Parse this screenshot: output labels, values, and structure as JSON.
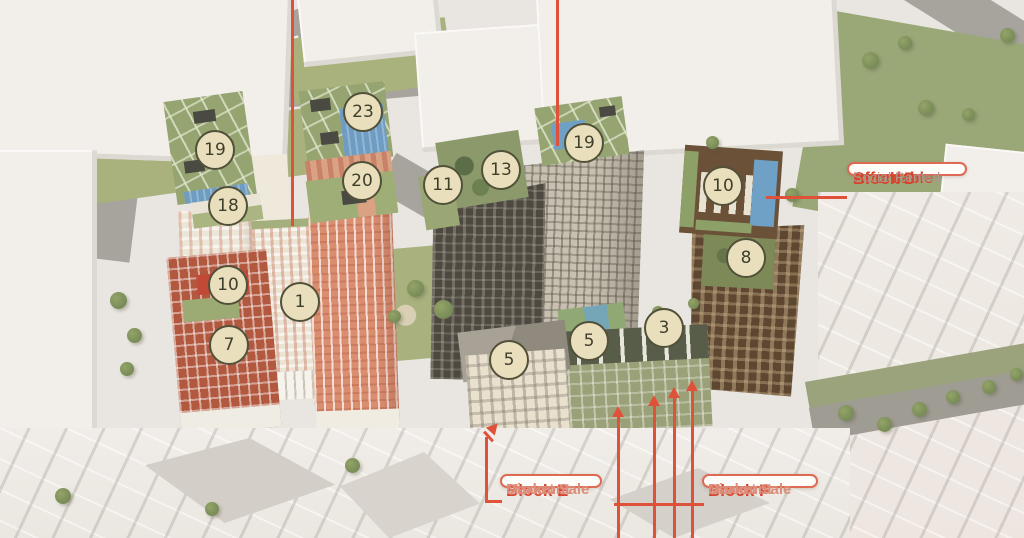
{
  "badges": [
    "19",
    "18",
    "10",
    "7",
    "23",
    "20",
    "1",
    "11",
    "13",
    "19",
    "10",
    "8",
    "5",
    "5",
    "3"
  ],
  "callouts": {
    "block_d": {
      "line1": "Block D",
      "line2": "Affordable",
      "line3": "Social Rented"
    },
    "block_e": {
      "line1": "Block E",
      "line2": "Discount",
      "line3": "Market Sale"
    },
    "block_f": {
      "line1": "Block F",
      "line2": "Discount",
      "line3": "Market Sale"
    }
  },
  "colors": {
    "annotation_red": "#e0513a",
    "callout_border": "#dd6a52",
    "callout_title": "#d6452e",
    "callout_subtitle": "#dd8d7a",
    "callout_muted": "#b5938a",
    "badge_fill": "#eadfbc",
    "badge_border": "#51513a",
    "badge_text": "#3e3e2c"
  }
}
